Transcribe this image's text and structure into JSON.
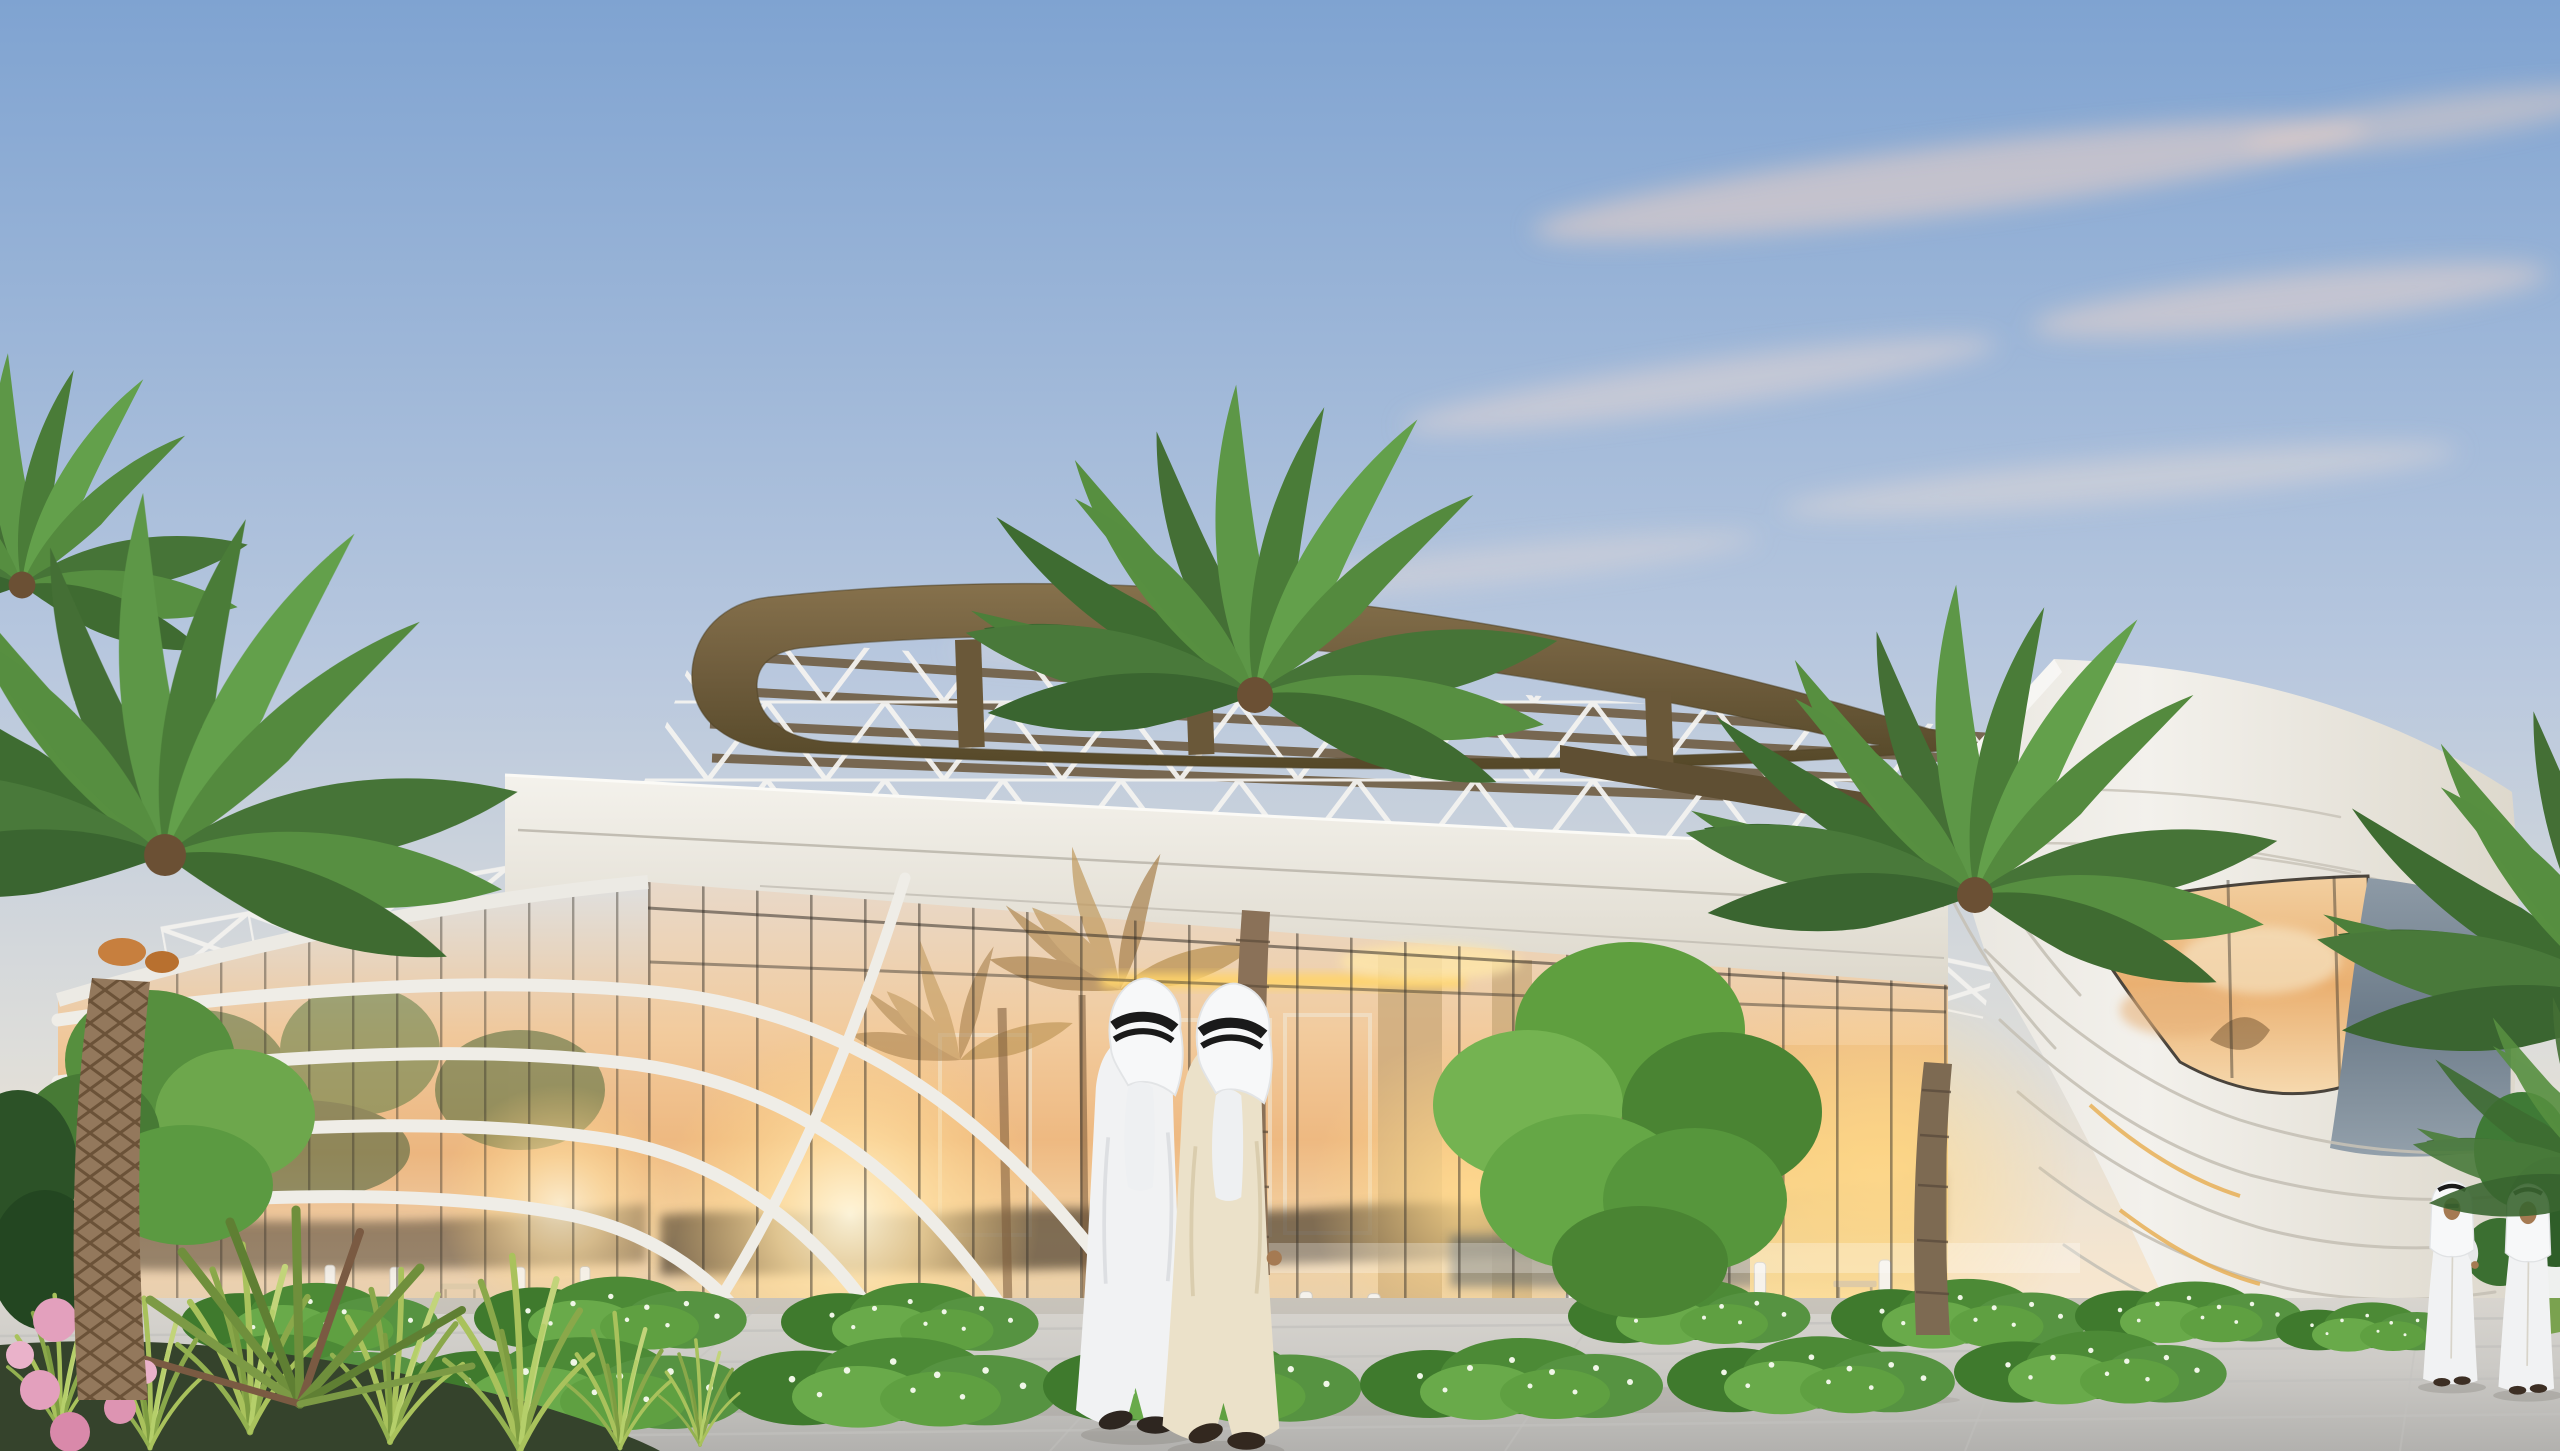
{
  "scene": {
    "type": "architectural exterior rendering",
    "time_of_day": "sunset",
    "sky": "clear gradient sky with thin pink clouds",
    "palette": {
      "sky_top": "#7fa3d1",
      "sky_mid": "#b7c7de",
      "sky_horizon": "#f6e6cf",
      "cloud_pink": "#eed3c6",
      "canopy_wood": "#6e5c3c",
      "canopy_wood_light": "#86714c",
      "steel_white": "#f1f0ed",
      "wall_white": "#f3f1ec",
      "wall_shadow": "#ddd8cc",
      "parapet_white": "#f4f2ec",
      "glass_peach": "#f0c89b",
      "glass_amber": "#ecb67f",
      "interior_glow": "#f6cd7e",
      "cove_light": "#ffd46a",
      "gray_glazing": "#6d7c8a",
      "treeline_reflection": "#4f4330",
      "pavement_far": "#d8d5cf",
      "pavement_near": "#b2b1ae",
      "hedge_green": "#4c8a36",
      "palm_green": "#4f7f3a",
      "palm_trunk": "#8a7158",
      "tree_green": "#5f9f3f",
      "grass_green": "#a9c25c",
      "flower_pink": "#e3a0bd",
      "thobe_white": "#f1f2f3",
      "thobe_cream": "#ebe1c9",
      "agal_black": "#1a1a1a",
      "skin": "#a57a52"
    },
    "building": {
      "roof_canopy": "elliptical wooden ribbon canopy over white space-frame truss",
      "railings": "white X-braced truss guardrails",
      "parapet": "white textured parapet band with reveal joints",
      "left_wing": "curved glass drum wrapped by sweeping white louver bands",
      "right_wing": "large white curved volume with horizontal reveal joints and gray glazing band",
      "feature_wall": "sculpted white wall with flowing grooves sweeping to the ground",
      "ground_floor": "full-height glazing reflecting the sunset with restaurant seating inside"
    },
    "landscape": {
      "palm_trees": 5,
      "green_trees": 3,
      "hedges": "low hedgerows with tiny white flowers",
      "foreground_bed": "ornamental grasses, spiky dracaena and pink flowers"
    },
    "people": [
      {
        "id": "pedestrian-1",
        "attire": "white thobe with white ghutra and black agal",
        "pose": "walking away, arm in arm, center"
      },
      {
        "id": "pedestrian-2",
        "attire": "cream thobe with white ghutra and black agal",
        "pose": "walking away, arm in arm, center"
      },
      {
        "id": "pedestrian-3",
        "attire": "white thobe with white ghutra and black agal",
        "pose": "walking toward viewer, right"
      },
      {
        "id": "pedestrian-4",
        "attire": "white thobe with white ghutra and black agal",
        "pose": "walking toward viewer, far right"
      }
    ]
  }
}
